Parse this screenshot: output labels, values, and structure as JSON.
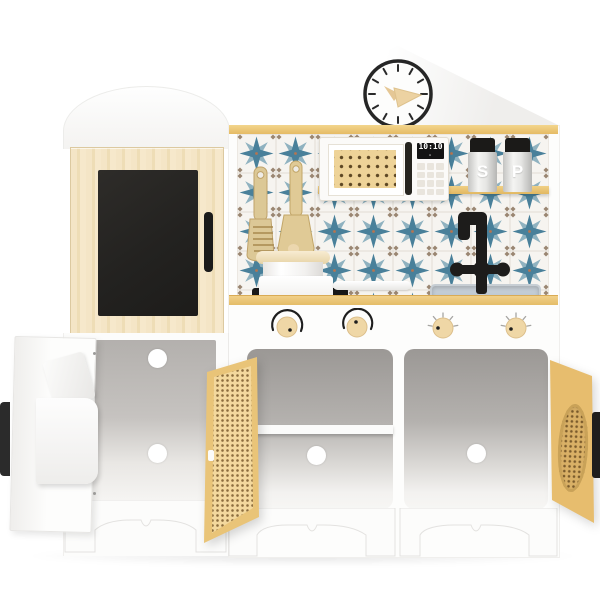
{
  "kitchen": {
    "microwave": {
      "display_time": "10:10"
    },
    "spice_jars": {
      "salt_label": "S",
      "pepper_label": "P"
    },
    "colors": {
      "wood_light": "#f2e3c3",
      "wood_trim": "#ecc97c",
      "rattan": "#f0d49a",
      "tile_star_blue": "#49809a",
      "chalkboard_black": "#26241f",
      "fixture_black": "#1d1c1b",
      "sink_blue_gray": "#b7c3cf",
      "body_white": "#fcfcfb"
    }
  }
}
